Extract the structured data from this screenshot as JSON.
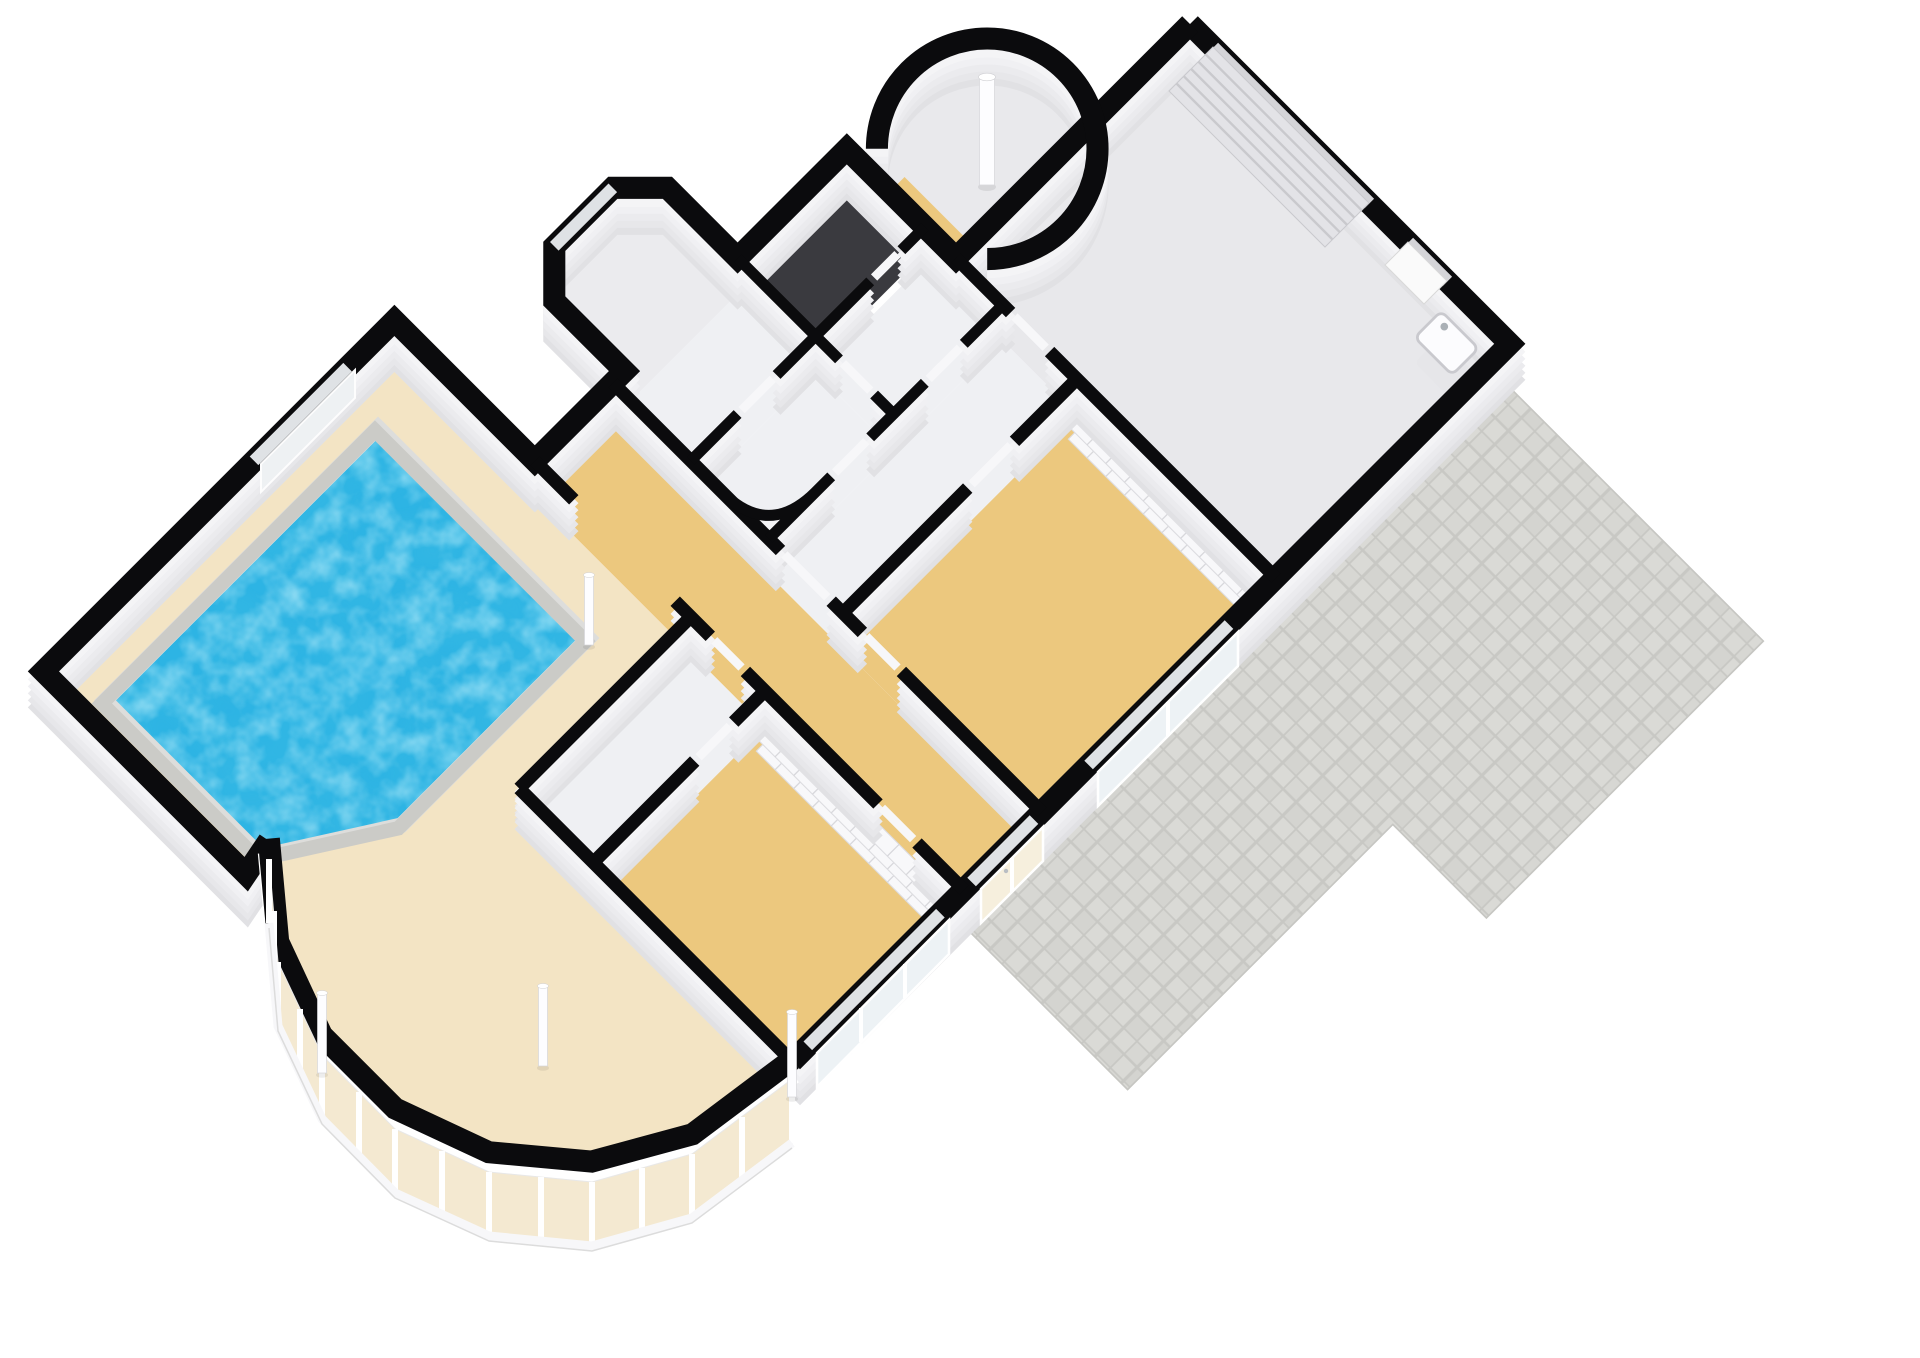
{
  "scene": {
    "kind": "3d-floorplan-isometric-render",
    "background": "#ffffff",
    "wall_style": "black cut tops with white faces",
    "view": "elevated oblique, building rotated ~45 degrees"
  },
  "palette": {
    "wall_top": "#0b0b0d",
    "wall_face": "#f4f4f6",
    "wall_face_shadow": "#e1e1e4",
    "floor_tan": "#ecc87e",
    "floor_gray": "#eff0f3",
    "garage_floor": "#e8e8eb",
    "vestibule_floor": "#ebebee",
    "turret_floor": "#e9e9ec",
    "deck": "#f3e4c4",
    "water": "#2db4e4",
    "pool_rim": "#cbcbc7",
    "patio": "#dadad6",
    "patio_grid": "#c8c8c4",
    "stair_dark": "#3a3a3f",
    "glass": "#edf2f5",
    "glazing_beige": "#f4e9d1",
    "frame_white": "#ffffff",
    "door_leaf": "#f7f7f9",
    "window_slit": "#dfe2e5",
    "garage_door_band": "#e3e3e7",
    "garage_door_slat": "#c9c9cd",
    "column_fill": "#fdfdff",
    "sink_fill": "#fcfcfe"
  },
  "rooms": [
    {
      "id": "garage",
      "floor": "gray"
    },
    {
      "id": "wardrobe-bedroom-east",
      "floor": "tan"
    },
    {
      "id": "inner-corridor",
      "floor": "gray"
    },
    {
      "id": "bathroom",
      "floor": "gray"
    },
    {
      "id": "shower-room",
      "floor": "gray"
    },
    {
      "id": "stairwell",
      "floor": "dark"
    },
    {
      "id": "hall-nook",
      "floor": "gray"
    },
    {
      "id": "entrance-vestibule",
      "floor": "gray"
    },
    {
      "id": "turret-room",
      "floor": "gray"
    },
    {
      "id": "main-hallway",
      "floor": "tan"
    },
    {
      "id": "office",
      "floor": "gray"
    },
    {
      "id": "south-bedroom",
      "floor": "tan"
    },
    {
      "id": "pool-hall",
      "floor": "deck"
    },
    {
      "id": "swimming-pool",
      "floor": "water"
    },
    {
      "id": "patio",
      "floor": "pavers"
    }
  ],
  "features": {
    "bay_window_mullions": 15,
    "garage_door_slats": 5,
    "columns": 5,
    "wardrobe_sections": 9,
    "windows": 4,
    "french_doors": 1,
    "turret_has_center_column": true,
    "pool_shape": "rectangle with beveled corner"
  }
}
